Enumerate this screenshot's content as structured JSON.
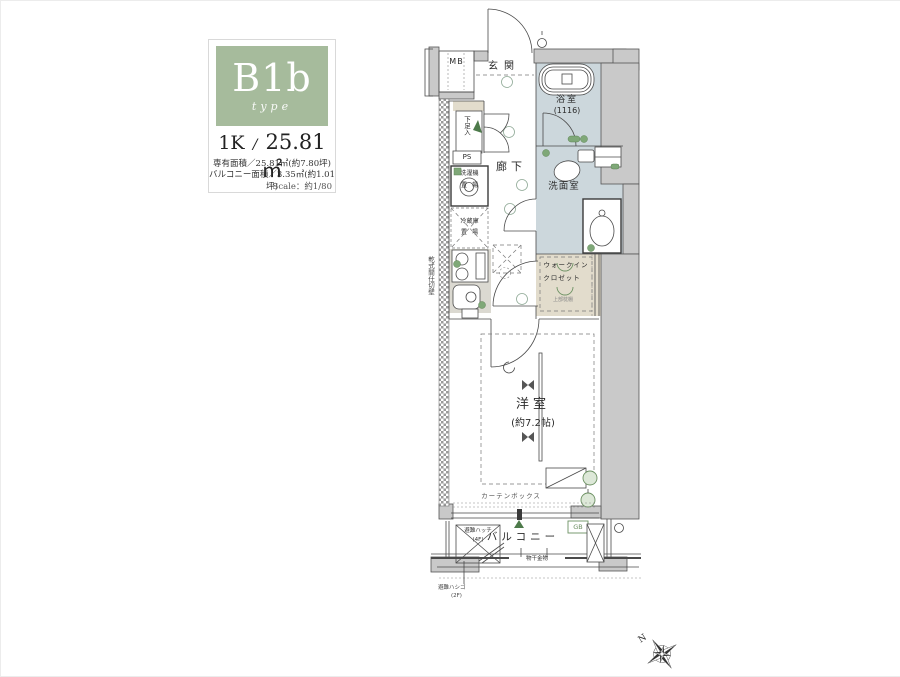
{
  "colors": {
    "panel_green": "#a6bb9c",
    "wall": "#c9c9c9",
    "bath_blue": "#ccd7dc",
    "closet_beige": "#e2dccc",
    "accent_green": "#7fa878"
  },
  "info_panel": {
    "type_code": "B1b",
    "type_script": "type",
    "plan_type": "1K",
    "separator": "/",
    "area": "25.81㎡",
    "detail_line1": "専有面積／25.81㎡(約7.80坪)",
    "detail_line2": "バルコニー面積／3.35㎡(約1.01坪)",
    "scale_note": "Scale：約1/80"
  },
  "plan": {
    "labels": {
      "mb": "MB",
      "genkan": "玄関",
      "bath": "浴室",
      "bath_size": "(1116)",
      "corridor": "廊下",
      "washroom": "洗面室",
      "shoe": "下足入",
      "ps": "PS",
      "washer_1": "洗濯機",
      "washer_2": "置場",
      "fridge_1": "冷蔵庫",
      "fridge_2": "置場",
      "wic_1": "ウォークイン",
      "wic_2": "クロゼット",
      "wic_note": "上部枕棚",
      "partition": "乾式間仕切壁",
      "room": "洋室",
      "room_size": "(約7.2帖)",
      "curtain": "カーテンボックス",
      "balcony": "バルコニー",
      "hatch_1": "避難ハッチ",
      "hatch_2": "(4F)",
      "drying": "物干金物",
      "ladder_1": "避難ハシゴ",
      "ladder_2": "(2F)",
      "gb": "GB"
    }
  },
  "compass": {
    "north": "N"
  }
}
